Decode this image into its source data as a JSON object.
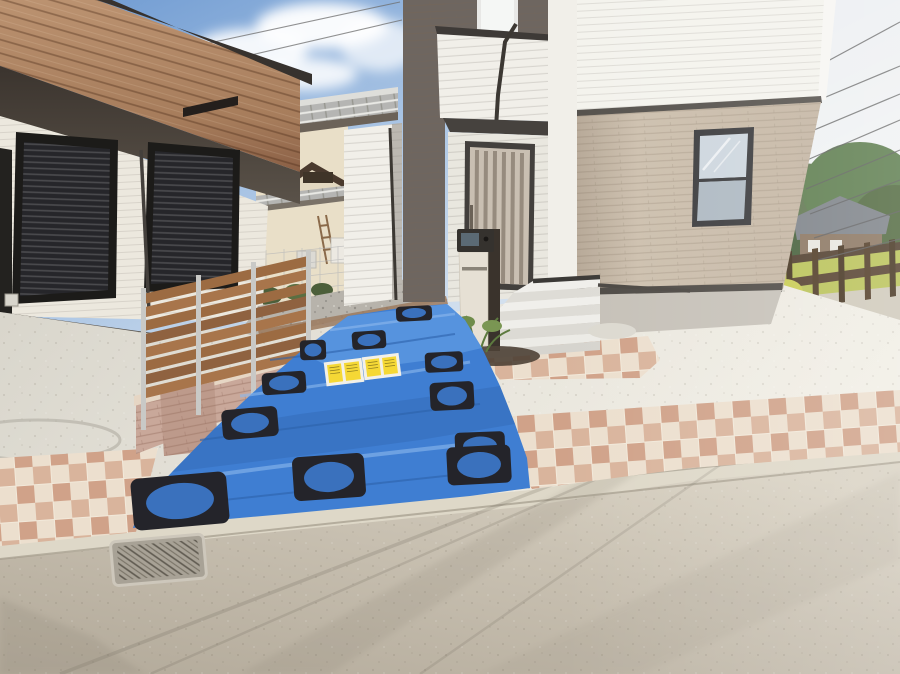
{
  "meta": {
    "type": "exterior-photograph",
    "description": "Street-level photo of a newly built light-toned two-story Japanese house. A blue tarp weighted with black ring plates covers the fresh concrete driveway. A horizontal wood-slat fence on a brick base stands left, a neighboring house with black roller shutters and a wood-look fascia is at far left, an older tiled-roof house sits behind, and power lines, a wooden guard fence, fields and a distant house fill the right background above the asphalt street.",
    "width": 900,
    "height": 674
  },
  "palette": {
    "sky_blue": "#6a97d0",
    "cloud_white": "#ffffff",
    "roof_dark": "#37322e",
    "wood_fascia": "#b08968",
    "siding_cream": "#ece8de",
    "stucco_cream": "#e9dfc8",
    "shutter_black": "#26262a",
    "house_white": "#f1efe9",
    "accent_gray": "#6e6660",
    "wall_beige": "#c9bcaa",
    "door_tan": "#c9bfb2",
    "tarp_blue": "#3f7ed2",
    "tarp_shade": "#3a71bd",
    "weight_black": "#24242a",
    "fence_wood": "#9c6b42",
    "brick_pink": "#c9a89a",
    "tile_pink": "#d9b49c",
    "tile_cream": "#ecdfce",
    "tile_rose": "#d0a289",
    "curb_concrete": "#ded8c8",
    "grass_green": "#b9c257",
    "tree_green": "#51693f",
    "label_yellow": "#f5d835"
  },
  "scene": {
    "sky": {
      "label": "blue sky with white clouds and overhead cables",
      "cable_count_right": 8
    },
    "left_house": {
      "label": "neighbor house with wood-look balcony fascia and closed black roller shutters",
      "shutters": 3,
      "extras": [
        "wall lamp",
        "downspout",
        "vent slit"
      ]
    },
    "middle_house": {
      "label": "older stucco house with two tiers of gray roof tiles",
      "extras": [
        "ladder",
        "small cabinet",
        "ac unit",
        "mesh fence with plants"
      ]
    },
    "main_house": {
      "label": "new house: white siding gable, dark gray accent panel, beige brick lower wall",
      "entrance": {
        "door": "vertical-slat tan front door",
        "steps": 4,
        "overhang": "dark soffit"
      },
      "post_unit": {
        "parts": [
          "intercom camera panel",
          "mail slot",
          "cream body",
          "dark rear post"
        ]
      },
      "accent_window": {
        "frame": "black",
        "panes": 2
      },
      "planting": [
        "low shrub",
        "dark mulch bed",
        "white pebbles"
      ]
    },
    "fence": {
      "label": "horizontal wood slat fence on pink brick base",
      "slats": 8,
      "metal_posts": 4,
      "brick_pillar": 1
    },
    "tarp": {
      "label": "blue protective tarp over curing driveway",
      "weights": 11,
      "warning_labels": 2,
      "label_text_legible": false
    },
    "tiles": {
      "label": "pink and cream checkered tile apron",
      "regions": 3
    },
    "street": {
      "label": "asphalt road with concrete curb",
      "extras": [
        "drainage grate",
        "manhole arc",
        "cable shadows"
      ]
    },
    "background_right": {
      "label": "wooden guard fence, yellow-green field, trees, distant gray-roof house"
    }
  }
}
